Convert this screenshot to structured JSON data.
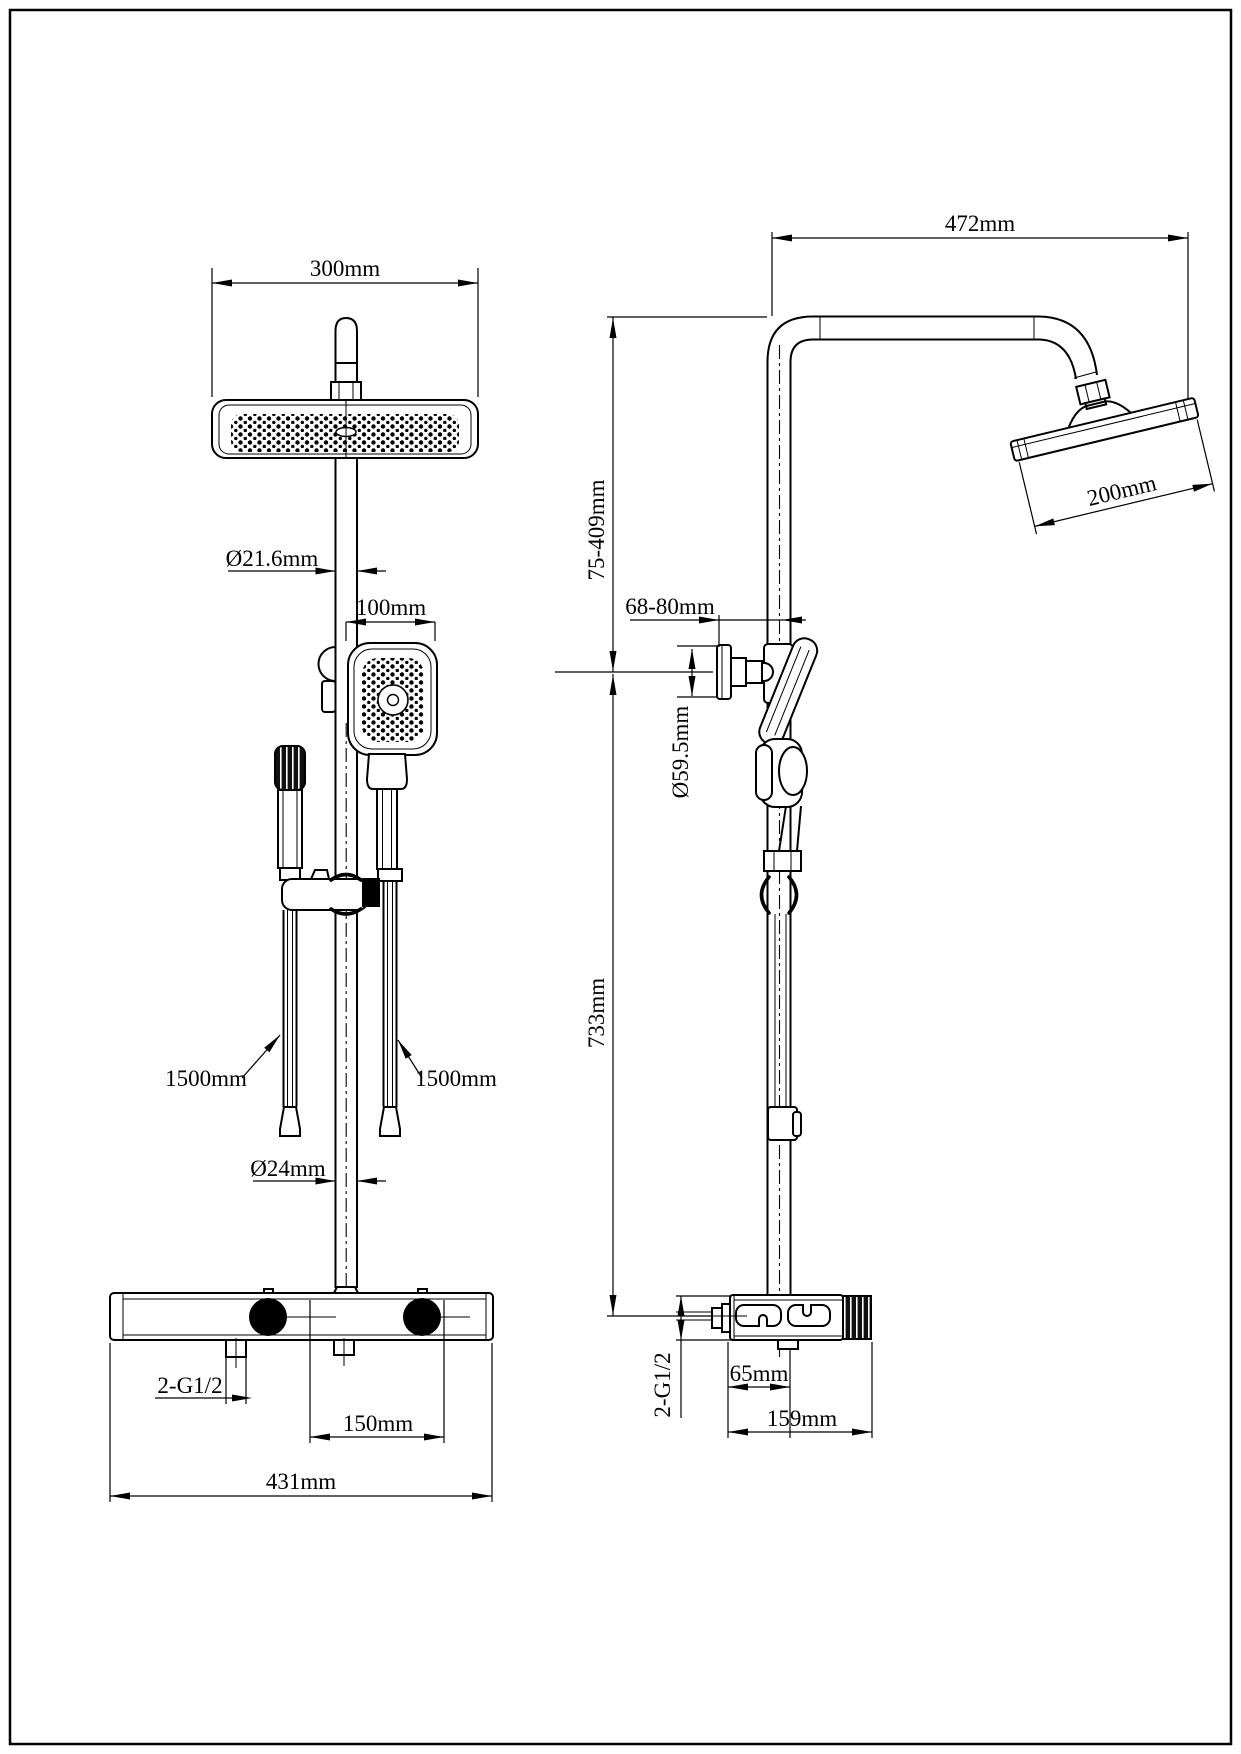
{
  "drawing": {
    "colors": {
      "line": "#000000",
      "background": "#ffffff"
    },
    "front": {
      "dim_head_width": "300mm",
      "dim_pipe_upper": "Ø21.6mm",
      "dim_hand_shower": "100mm",
      "dim_hose_left": "1500mm",
      "dim_hose_right": "1500mm",
      "dim_pipe_lower": "Ø24mm",
      "dim_inlet_thread": "2-G1/2",
      "dim_outlet_spacing": "150mm",
      "dim_bar_width": "431mm"
    },
    "side": {
      "dim_arm_reach": "472mm",
      "dim_head_depth": "200mm",
      "dim_upper_height": "75-409mm",
      "dim_wall_distance": "68-80mm",
      "dim_bracket_dia": "Ø59.5mm",
      "dim_lower_height": "733mm",
      "dim_inlet_thread": "2-G1/2",
      "dim_outlet_offset": "65mm",
      "dim_valve_depth": "159mm"
    }
  }
}
